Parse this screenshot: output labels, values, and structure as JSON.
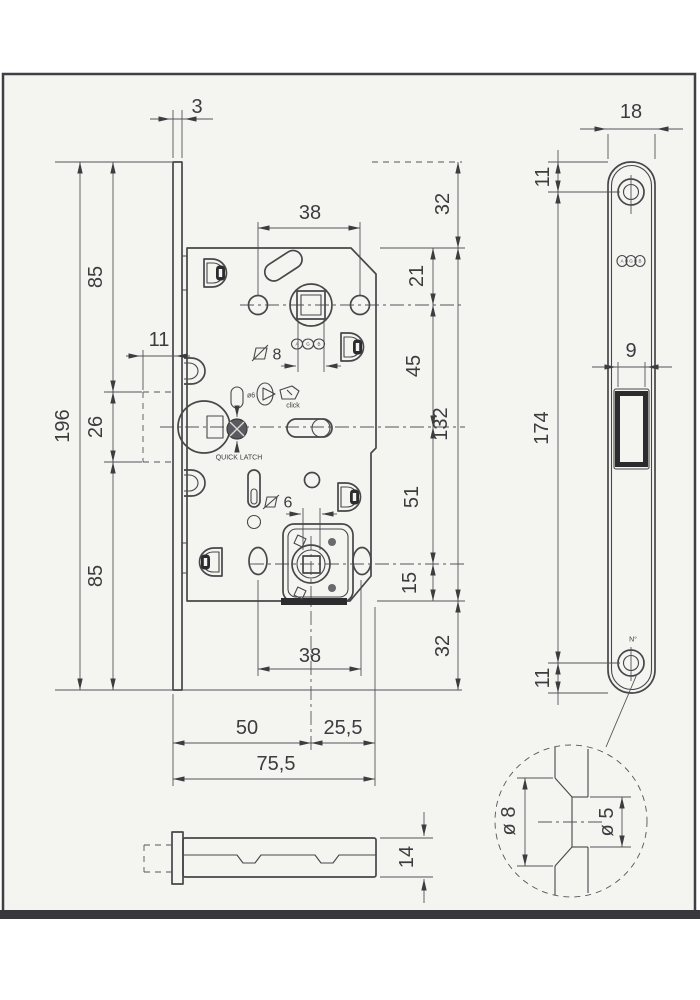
{
  "front_view": {
    "dim_thickness": "3",
    "dim_top_spacing": "38",
    "dim_height": "196",
    "dim_upper": "85",
    "dim_magnet": "26",
    "dim_lower": "85",
    "dim_magnet_depth": "11",
    "dim_overhang_top": "32",
    "dim_case_top": "21",
    "dim_spindle_magnet": "45",
    "dim_case_height": "132",
    "dim_magnet_wc": "51",
    "dim_wc_bottom": "15",
    "dim_overhang_bottom": "32",
    "dim_bottom_spacing": "38",
    "dim_backset": "50",
    "dim_case_ext": "25,5",
    "dim_total": "75,5",
    "label_square8": "8",
    "label_square6": "6",
    "label_pin": "ø6",
    "label_click": "click",
    "label_quick_latch": "QUICK LATCH"
  },
  "side_view": {
    "dim_depth": "14"
  },
  "faceplate_view": {
    "dim_width": "18",
    "dim_top_hole": "11",
    "dim_window": "9",
    "dim_holes": "174",
    "dim_bottom_hole": "11",
    "label_number": "N°"
  },
  "detail_view": {
    "dim_countersink": "ø 8",
    "dim_hole": "ø 5"
  },
  "brand": {
    "a": "A",
    "g": "G",
    "b": "B"
  },
  "colors": {
    "paper": "#f4f4f1",
    "line": "#47474a",
    "dim": "#55555a",
    "dark": "#2c2c2f",
    "frame": "#3f3f44"
  }
}
